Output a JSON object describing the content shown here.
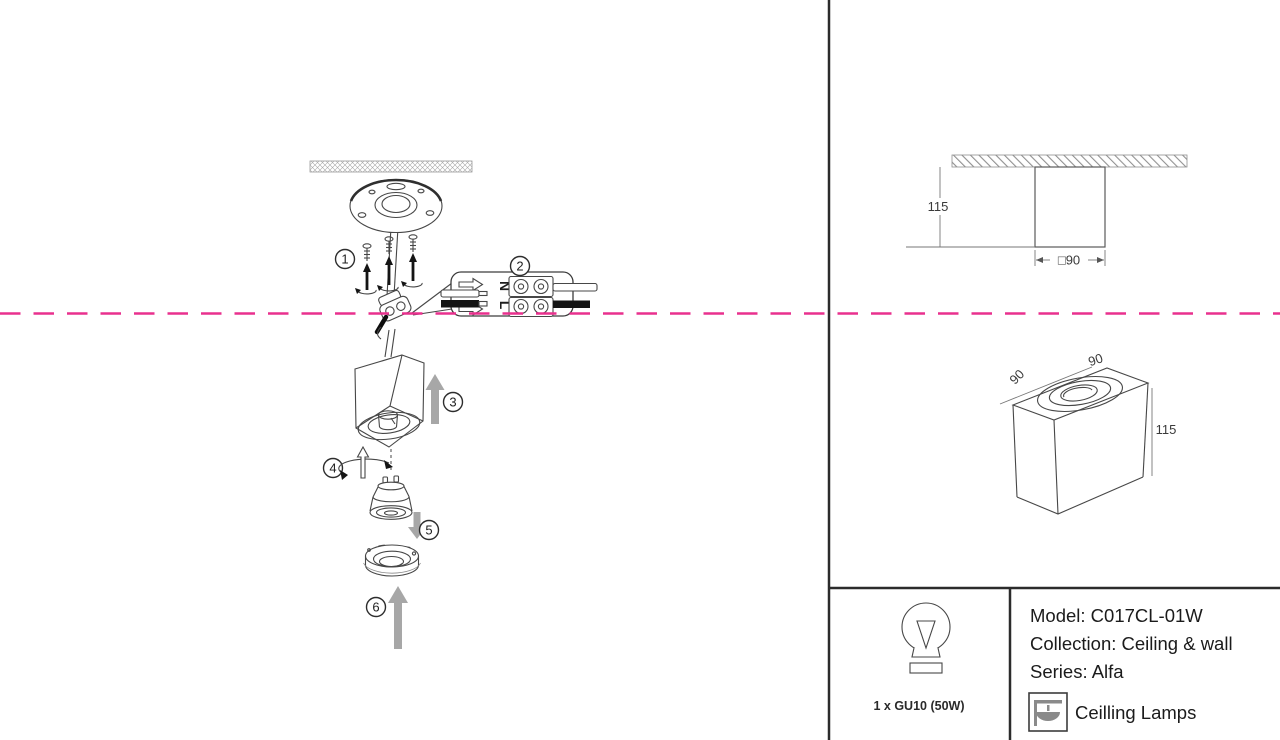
{
  "colors": {
    "dashed_line": "#e9308e",
    "line": "#474747",
    "arrow_gray": "#a7a7a7"
  },
  "steps": [
    "1",
    "2",
    "3",
    "4",
    "5",
    "6"
  ],
  "wiring": {
    "neutral": "N",
    "live": "L"
  },
  "front_view": {
    "height": "115",
    "width": "□90"
  },
  "iso_view": {
    "edge_left": "90",
    "edge_top": "90",
    "height": "115"
  },
  "spec": {
    "bulb": "1 x GU10 (50W)",
    "model": "Model: C017CL-01W",
    "collection": "Collection: Ceiling & wall",
    "series": "Series: Alfa",
    "category": "Ceilling Lamps"
  }
}
